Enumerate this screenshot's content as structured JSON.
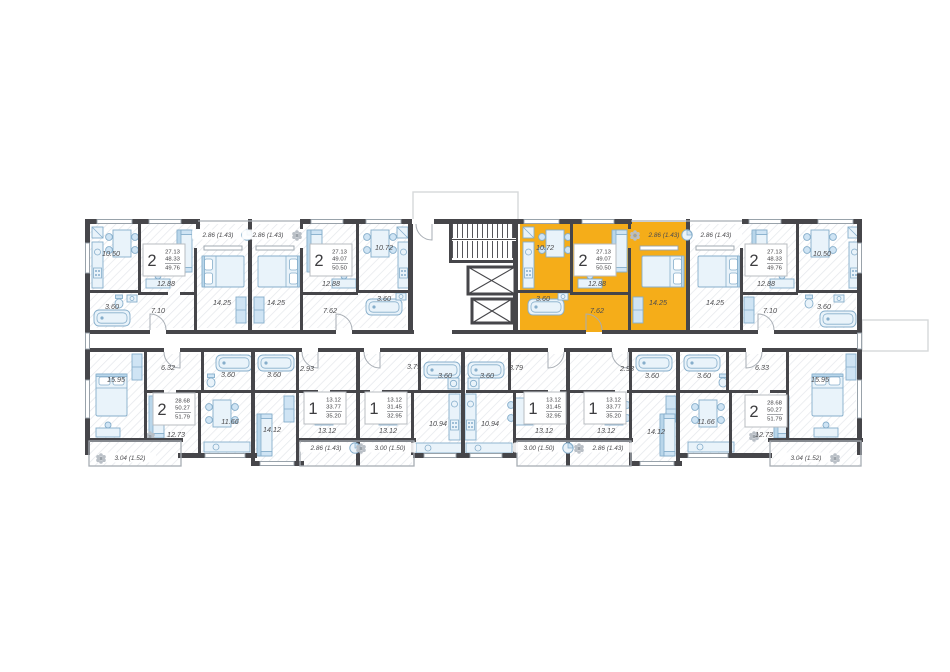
{
  "palette": {
    "highlight": "#f5ad19",
    "walls": "#46464a",
    "furniture": "#dcecf7",
    "furniture_stroke": "#86aecb",
    "label_text": "#4c4c4f"
  },
  "core": {
    "stairs": true,
    "elevators": 2
  },
  "apartments": {
    "top": [
      {
        "type": "2-room",
        "rooms_count": "2",
        "living_area": "27.13",
        "floor_area": "48.33",
        "total_area": "49.76",
        "highlighted": false,
        "areas": {
          "kitchen": "10.50",
          "living": "12.88",
          "bedroom": "14.25",
          "bath": "3.60",
          "hall": "7.10",
          "balcony": "2.86 (1.43)"
        }
      },
      {
        "type": "2-room",
        "rooms_count": "2",
        "living_area": "27.13",
        "floor_area": "49.07",
        "total_area": "50.50",
        "highlighted": false,
        "areas": {
          "kitchen": "10.72",
          "living": "12.88",
          "bedroom": "14.25",
          "bath": "3.60",
          "hall": "7.62",
          "balcony": "2.86 (1.43)"
        }
      },
      {
        "type": "2-room",
        "rooms_count": "2",
        "living_area": "27.13",
        "floor_area": "49.07",
        "total_area": "50.50",
        "highlighted": true,
        "areas": {
          "kitchen": "10.72",
          "living": "12.88",
          "bedroom": "14.25",
          "bath": "3.60",
          "hall": "7.62",
          "balcony": "2.86 (1.43)"
        }
      },
      {
        "type": "2-room",
        "rooms_count": "2",
        "living_area": "27.13",
        "floor_area": "48.33",
        "total_area": "49.76",
        "highlighted": false,
        "areas": {
          "kitchen": "10.50",
          "living": "12.88",
          "bedroom": "14.25",
          "bath": "3.60",
          "hall": "7.10",
          "balcony": "2.86 (1.43)"
        }
      }
    ],
    "bottom": [
      {
        "type": "2-room",
        "rooms_count": "2",
        "living_area": "28.68",
        "floor_area": "50.27",
        "total_area": "51.79",
        "highlighted": false,
        "areas": {
          "bedroom": "15.95",
          "living": "12.73",
          "kitchen": "11.66",
          "hall": "6.32",
          "bath": "3.60",
          "balcony": "3.04 (1.52)"
        }
      },
      {
        "type": "1-room",
        "rooms_count": "1",
        "living_area": "13.12",
        "floor_area": "33.77",
        "total_area": "35.20",
        "highlighted": false,
        "areas": {
          "living": "13.12",
          "kitchen": "14.12",
          "hall": "2.93",
          "bath": "3.60",
          "balcony": "2.86 (1.43)"
        }
      },
      {
        "type": "1-room",
        "rooms_count": "1",
        "living_area": "13.12",
        "floor_area": "31.45",
        "total_area": "32.95",
        "highlighted": false,
        "areas": {
          "living": "13.12",
          "kitchen": "10.94",
          "hall": "3.79",
          "bath": "3.60",
          "balcony": "3.00 (1.50)"
        }
      },
      {
        "type": "1-room",
        "rooms_count": "1",
        "living_area": "13.12",
        "floor_area": "31.45",
        "total_area": "32.95",
        "highlighted": false,
        "areas": {
          "living": "13.12",
          "kitchen": "10.94",
          "hall": "3.79",
          "bath": "3.60",
          "balcony": "3.00 (1.50)"
        }
      },
      {
        "type": "1-room",
        "rooms_count": "1",
        "living_area": "13.12",
        "floor_area": "33.77",
        "total_area": "35.20",
        "highlighted": false,
        "areas": {
          "living": "13.12",
          "kitchen": "14.12",
          "hall": "2.93",
          "bath": "3.60",
          "balcony": "2.86 (1.43)"
        }
      },
      {
        "type": "2-room",
        "rooms_count": "2",
        "living_area": "28.68",
        "floor_area": "50.27",
        "total_area": "51.79",
        "highlighted": false,
        "areas": {
          "bedroom": "15.95",
          "living": "12.73",
          "kitchen": "11.66",
          "hall": "6.33",
          "bath": "3.60",
          "balcony": "3.04 (1.52)"
        }
      }
    ]
  }
}
